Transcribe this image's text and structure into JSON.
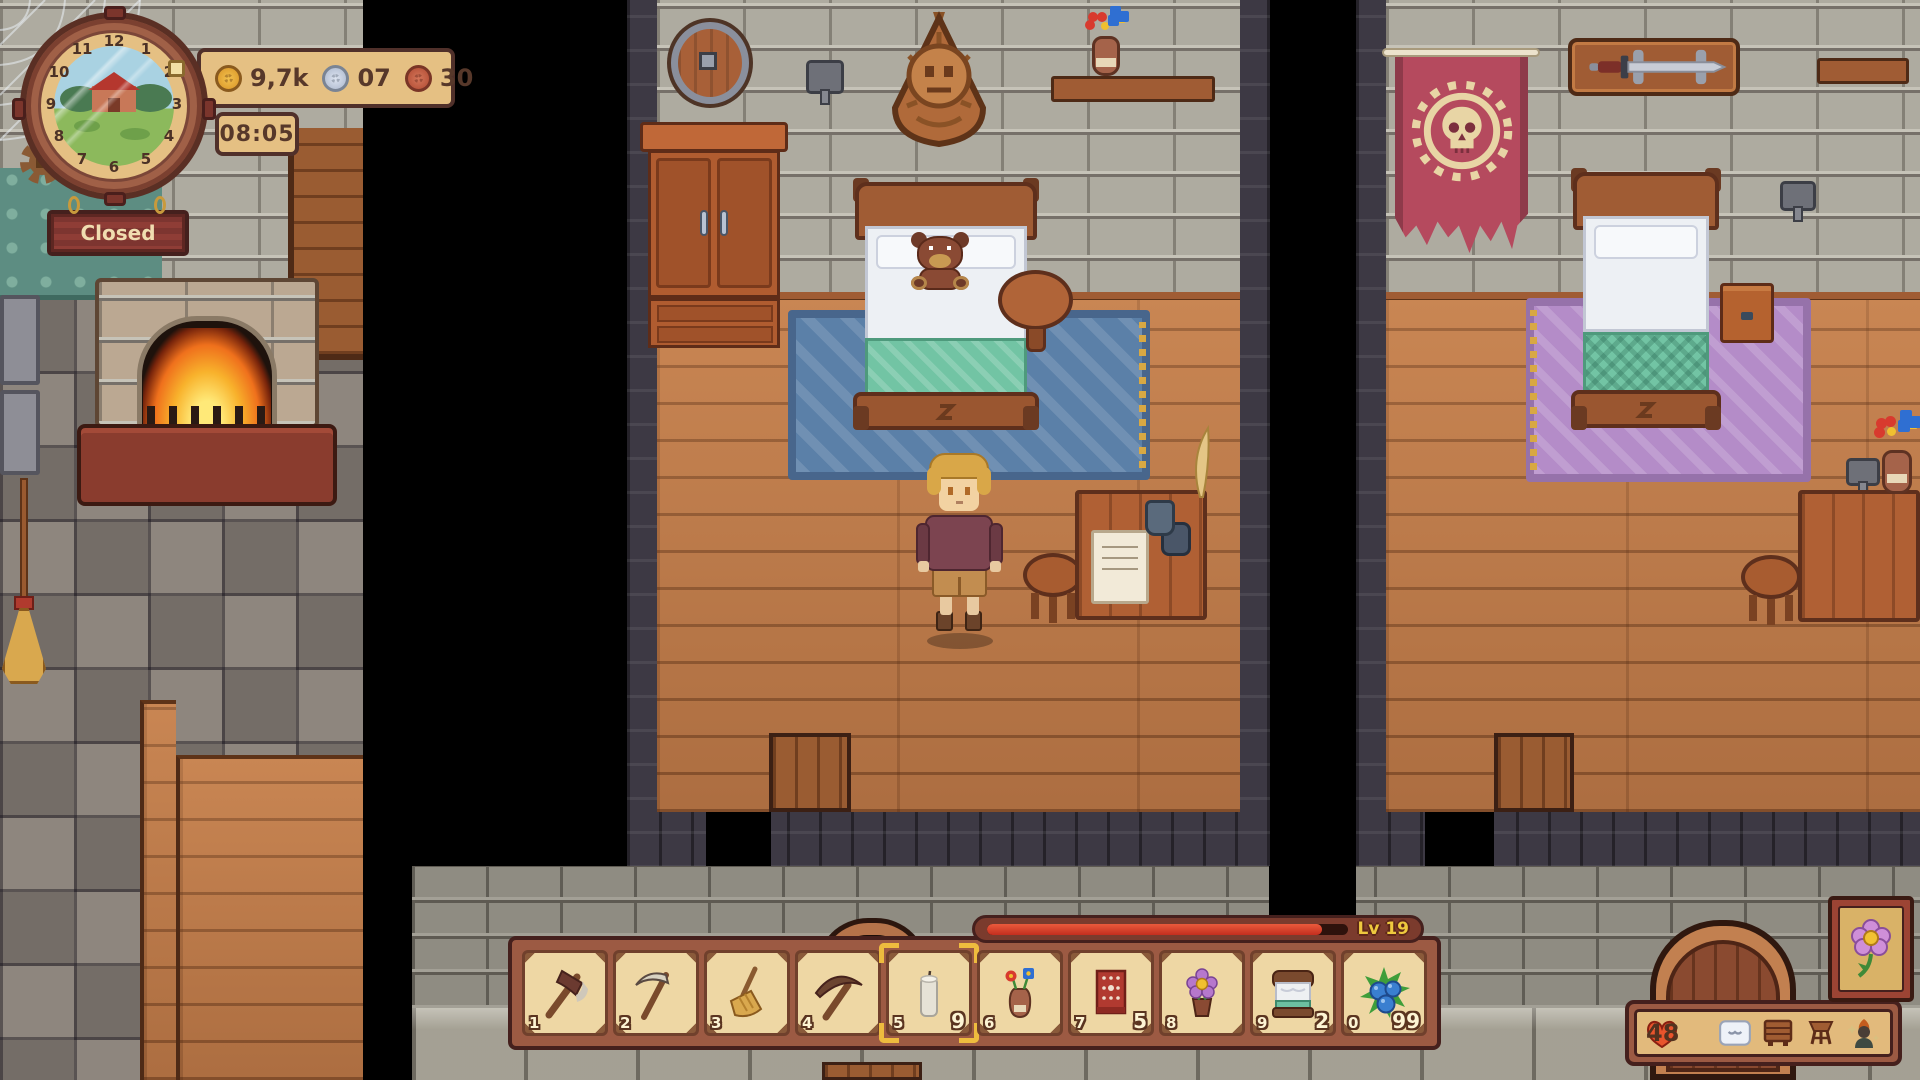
{
  "hud": {
    "clock": {
      "numerals": [
        "12",
        "1",
        "2",
        "3",
        "4",
        "5",
        "6",
        "7",
        "8",
        "9",
        "10",
        "11"
      ],
      "time": "08:05",
      "scene": "farm-with-red-house"
    },
    "currency": {
      "gold": "9,7k",
      "silver": "07",
      "copper": "30"
    },
    "shop_status": "Closed",
    "level": {
      "label": "Lv 19",
      "xp_percent": 93
    },
    "status": {
      "health": "48",
      "icons": [
        "pillow-icon",
        "dresser-icon",
        "stool-icon",
        "villager-icon"
      ]
    },
    "corner_button": {
      "icon": "flower-icon"
    },
    "hotbar": {
      "selected_index": 4,
      "slots": [
        {
          "num": "1",
          "item": "axe",
          "count": ""
        },
        {
          "num": "2",
          "item": "scythe",
          "count": ""
        },
        {
          "num": "3",
          "item": "broom",
          "count": ""
        },
        {
          "num": "4",
          "item": "pickaxe",
          "count": ""
        },
        {
          "num": "5",
          "item": "candle",
          "count": "9",
          "selected": true
        },
        {
          "num": "6",
          "item": "flower-vase",
          "count": ""
        },
        {
          "num": "7",
          "item": "red-cloth",
          "count": "5"
        },
        {
          "num": "8",
          "item": "potted-flower",
          "count": ""
        },
        {
          "num": "9",
          "item": "bed",
          "count": "2"
        },
        {
          "num": "0",
          "item": "blueberries",
          "count": "99"
        }
      ]
    }
  },
  "colors": {
    "ui_tan": "#e5c083",
    "ui_outline": "#50302a",
    "ui_frame": "#9c5a43",
    "sign_red": "#7d3530",
    "xp_red": "#cf3020",
    "level_text": "#eec93e",
    "select_gold": "#eebc3e",
    "banner_red": "#b54a5e",
    "rug_blue": "#5b80a8",
    "rug_purple": "#b48cc8",
    "wood_floor": "#c07a48",
    "stone_wall": "#aeaba0"
  }
}
